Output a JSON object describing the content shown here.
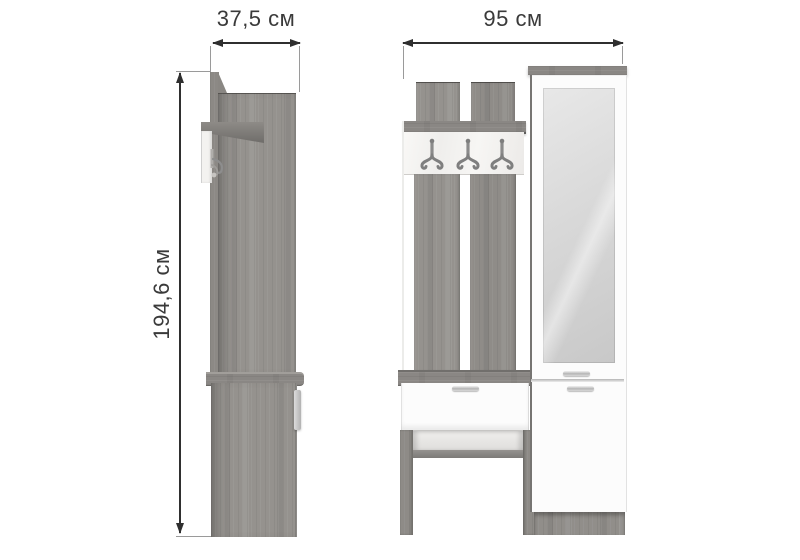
{
  "diagram": {
    "depth_label": "37,5 см",
    "width_label": "95 см",
    "height_label": "194,6 см"
  },
  "product": {
    "hooks_count": 3,
    "views": [
      "side",
      "front"
    ]
  },
  "colors": {
    "background": "#ffffff",
    "wood": "#95928e",
    "wood_dark": "#8a8784",
    "white_furniture": "#fcfcfc",
    "mirror": "#d9d9d9",
    "dimension_line": "#2f2f2f",
    "label_text": "#3a3a3a"
  }
}
